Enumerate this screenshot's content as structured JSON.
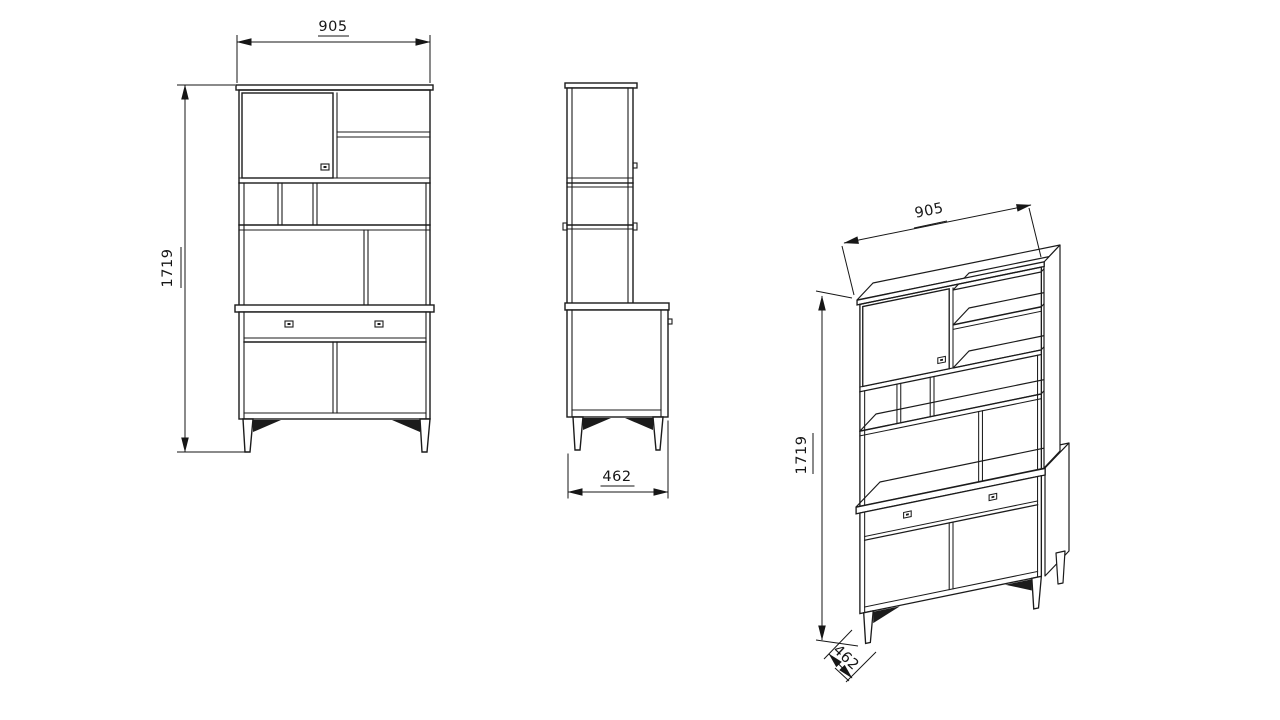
{
  "page": {
    "background": "#ffffff"
  },
  "drawing": {
    "kind": "furniture cabinet technical drawing",
    "line_color": "#1b1b1b",
    "views": {
      "front": {
        "width_label": "905",
        "height_label": "1719"
      },
      "side": {
        "depth_label": "462"
      },
      "isometric": {
        "width_label": "905",
        "height_label": "1719",
        "depth_label": "462"
      }
    }
  }
}
